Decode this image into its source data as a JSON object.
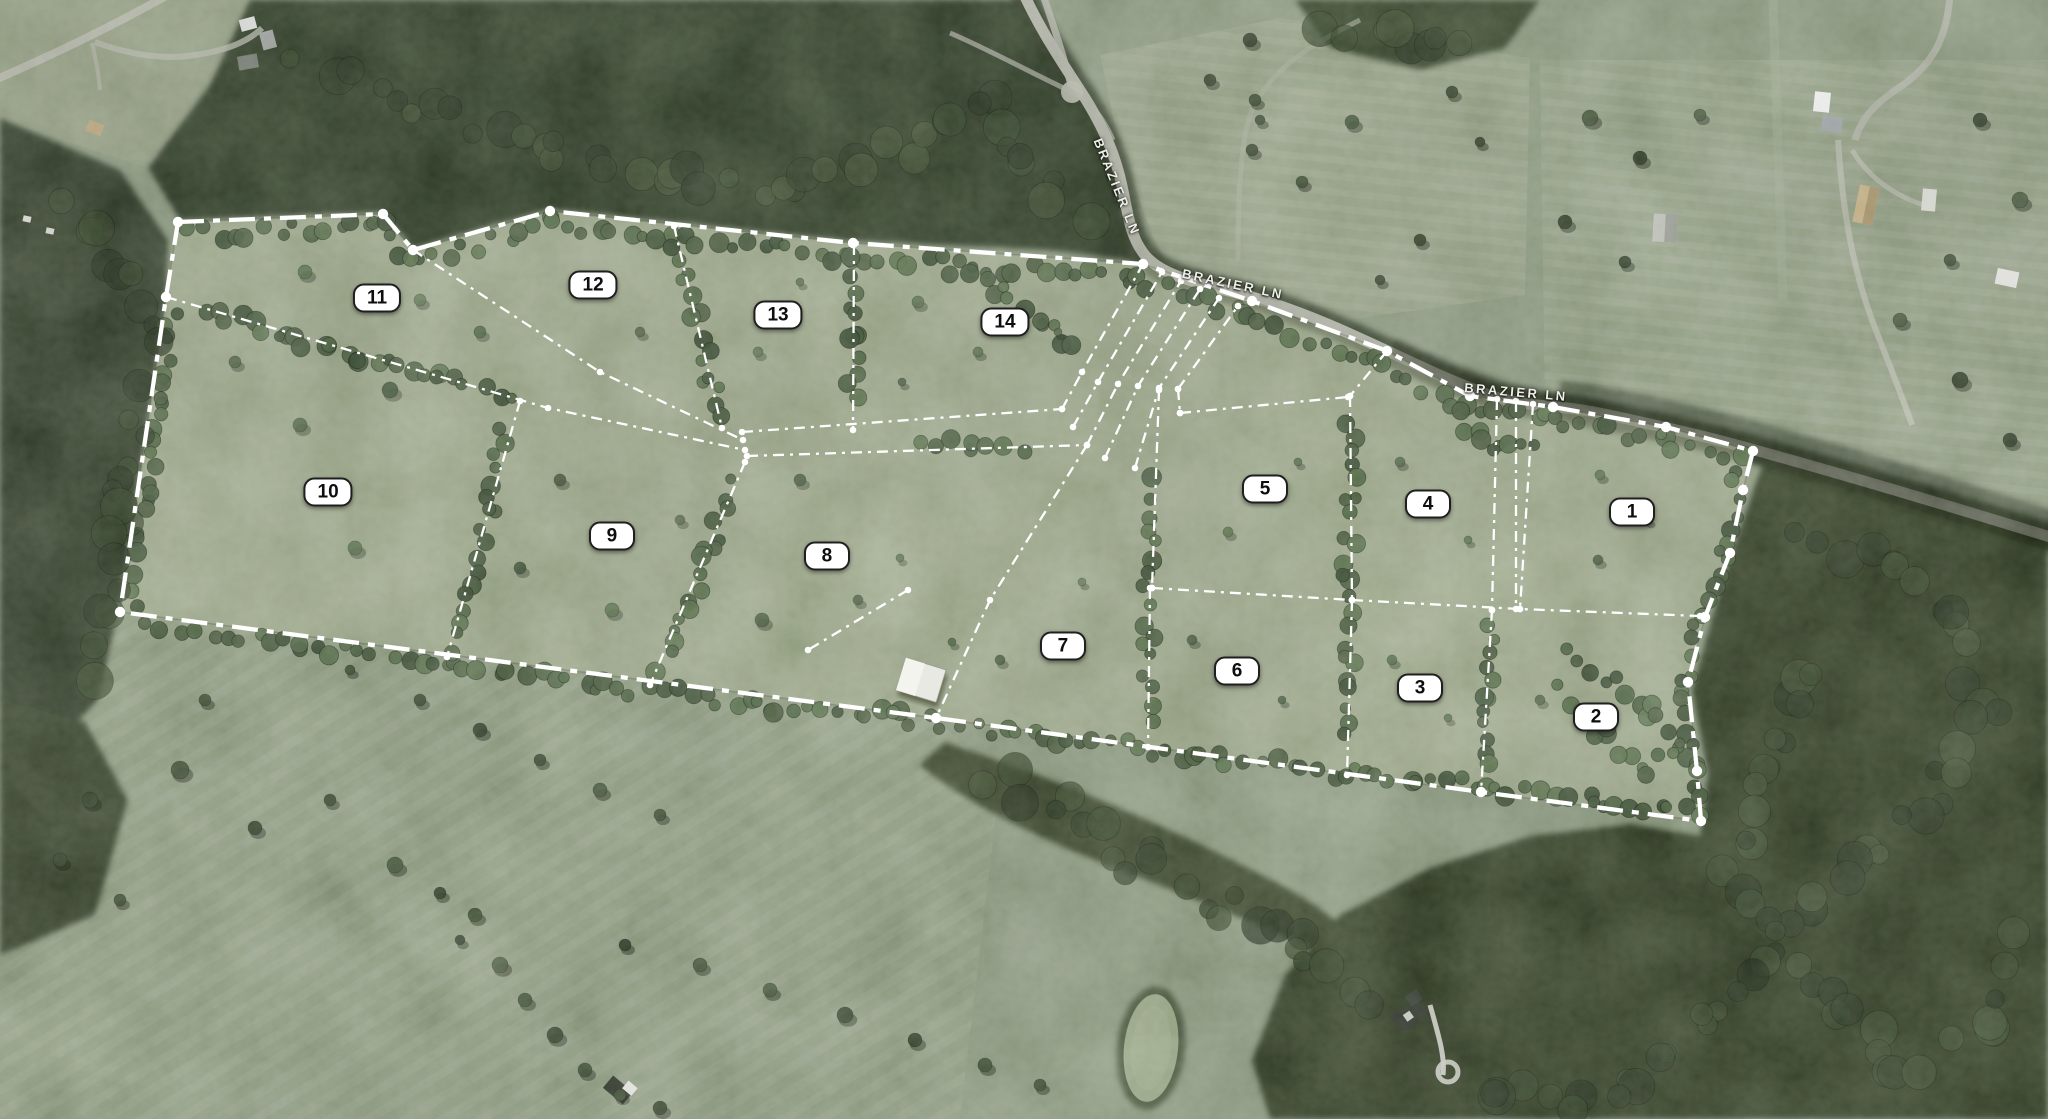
{
  "map": {
    "road": {
      "name_labels": [
        {
          "text": "BRAZIER LN",
          "x_pct": 54.54,
          "y_pct": 16.71,
          "angle_deg": 68
        },
        {
          "text": "BRAZIER LN",
          "x_pct": 60.21,
          "y_pct": 25.38,
          "angle_deg": 12
        },
        {
          "text": "BRAZIER LN",
          "x_pct": 74.02,
          "y_pct": 35.03,
          "angle_deg": 5
        }
      ]
    },
    "lots": [
      {
        "number": "1",
        "x_pct": 79.69,
        "y_pct": 45.76
      },
      {
        "number": "2",
        "x_pct": 77.93,
        "y_pct": 64.08
      },
      {
        "number": "3",
        "x_pct": 69.34,
        "y_pct": 61.48
      },
      {
        "number": "4",
        "x_pct": 69.73,
        "y_pct": 45.04
      },
      {
        "number": "5",
        "x_pct": 61.77,
        "y_pct": 43.7
      },
      {
        "number": "6",
        "x_pct": 60.4,
        "y_pct": 59.96
      },
      {
        "number": "7",
        "x_pct": 51.9,
        "y_pct": 57.73
      },
      {
        "number": "8",
        "x_pct": 40.38,
        "y_pct": 49.69
      },
      {
        "number": "9",
        "x_pct": 29.88,
        "y_pct": 47.9
      },
      {
        "number": "10",
        "x_pct": 16.02,
        "y_pct": 43.97
      },
      {
        "number": "11",
        "x_pct": 18.41,
        "y_pct": 26.63
      },
      {
        "number": "12",
        "x_pct": 28.96,
        "y_pct": 25.47
      },
      {
        "number": "13",
        "x_pct": 37.99,
        "y_pct": 28.15
      },
      {
        "number": "14",
        "x_pct": 49.07,
        "y_pct": 28.78
      }
    ],
    "colors": {
      "boundary_line": "#ffffff",
      "lot_line": "#ffffff",
      "lot_label_bg": "#ffffff",
      "lot_label_text": "#111111",
      "lot_label_border": "#1f1f1f",
      "road_label_text": "#eef0e8",
      "property_highlight": "#b3bd98"
    }
  }
}
